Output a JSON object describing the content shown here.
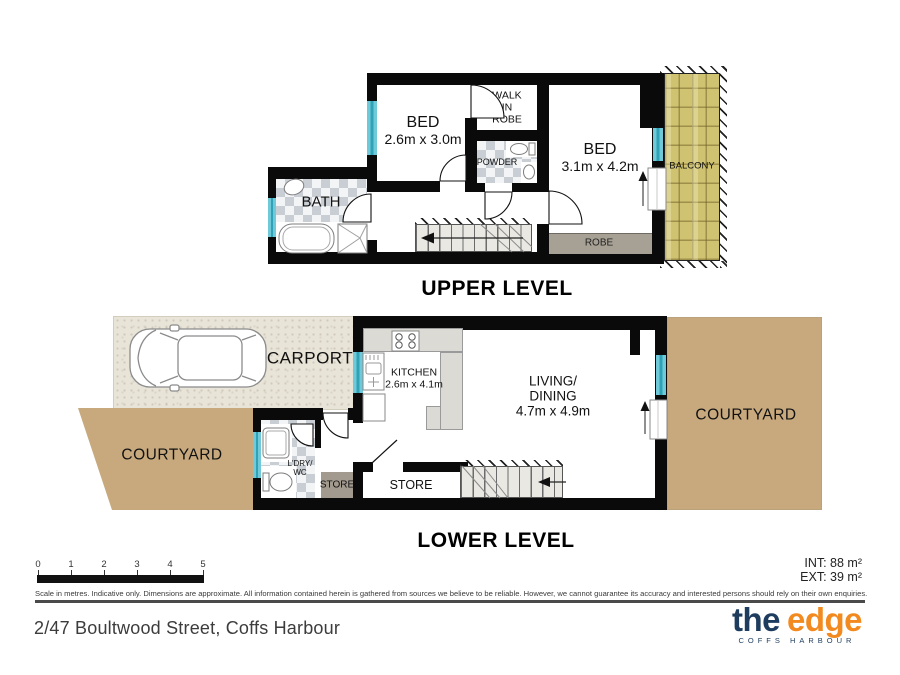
{
  "upper": {
    "title": "UPPER LEVEL",
    "bed1": {
      "name": "BED",
      "dims": "2.6m x 3.0m"
    },
    "bed2": {
      "name": "BED",
      "dims": "3.1m x 4.2m"
    },
    "wir": [
      "WALK",
      "IN",
      "ROBE"
    ],
    "powder": "POWDER",
    "bath": "BATH",
    "robe": "ROBE",
    "balcony": "BALCONY"
  },
  "lower": {
    "title": "LOWER LEVEL",
    "carport": "CARPORT",
    "kitchen": {
      "name": "KITCHEN",
      "dims": "2.6m x 4.1m"
    },
    "fridge": "F",
    "living": {
      "line1": "LIVING/",
      "line2": "DINING",
      "dims": "4.7m x 4.9m"
    },
    "courtyard_left": "COURTYARD",
    "courtyard_right": "COURTYARD",
    "laundry": {
      "line1": "L'DRY/",
      "line2": "WC"
    },
    "store_small": "STORE",
    "store_room": "STORE"
  },
  "scale": {
    "ticks": [
      "0",
      "1",
      "2",
      "3",
      "4",
      "5"
    ]
  },
  "areas": {
    "interior": "INT: 88 m²",
    "exterior": "EXT: 39 m²"
  },
  "disclaimer": "Scale in metres. Indicative only. Dimensions are approximate. All information contained herein is gathered from sources we believe to be reliable. However, we cannot guarantee its accuracy and interested persons should rely on their own enquiries.",
  "footer": {
    "address": "2/47 Boultwood Street, Coffs Harbour",
    "logo": {
      "word1": "the",
      "word2": "edge",
      "tagline": "COFFS HARBOUR"
    }
  },
  "colors": {
    "wall": "#0a0a0a",
    "window": "#6fc9d8",
    "logo_navy": "#1d3c5e",
    "logo_orange": "#f28a20",
    "paver": "#c8a97d",
    "balcony_tile": "#cfc271"
  }
}
